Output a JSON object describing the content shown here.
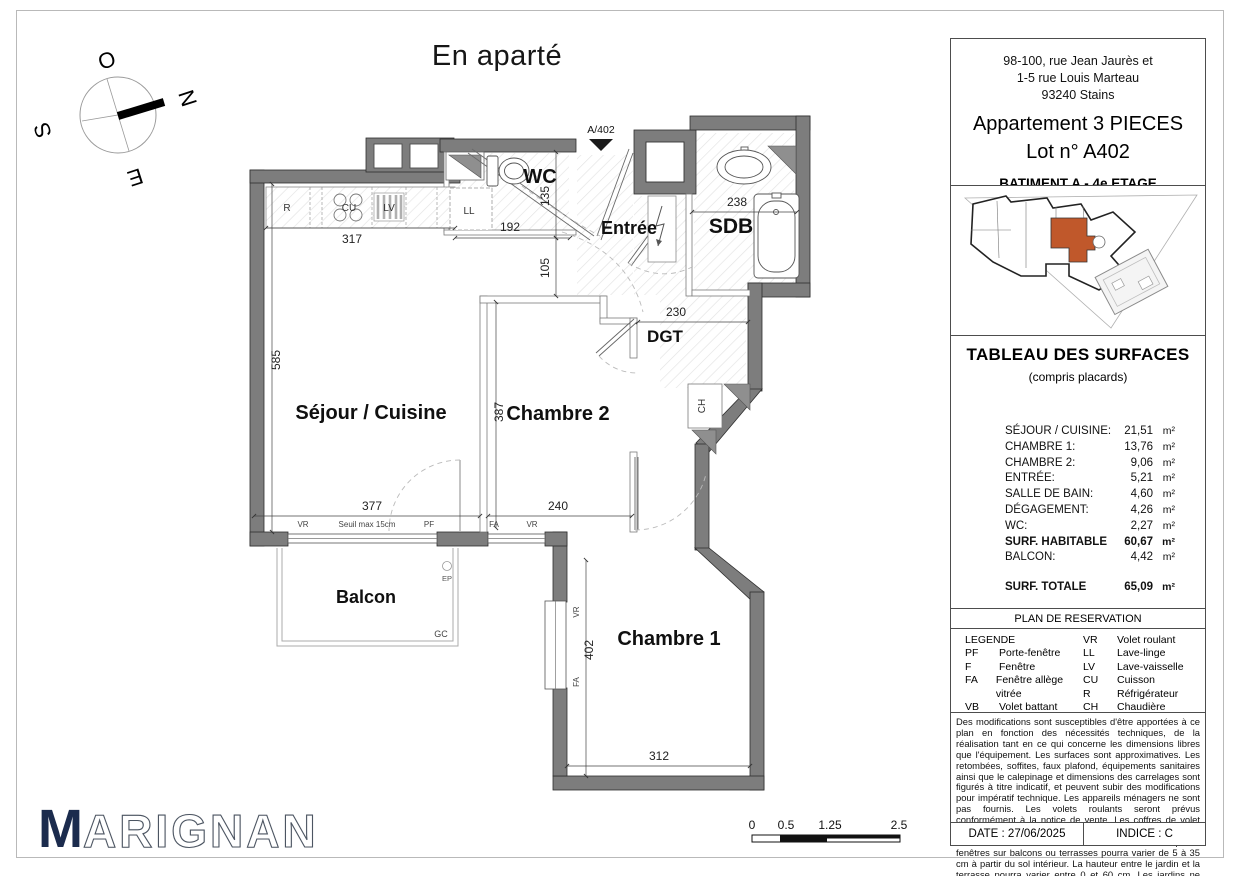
{
  "title": "En aparté",
  "colors": {
    "accent": "#C0582B",
    "wall": "#7D7D7D",
    "navy": "#1B2B4D"
  },
  "compass": {
    "o": "O",
    "n": "N",
    "s": "S",
    "e": "E"
  },
  "plan": {
    "marker": "A/402",
    "rooms": {
      "wc": "WC",
      "entree": "Entrée",
      "sdb": "SDB",
      "dgt": "DGT",
      "sejour": "Séjour / Cuisine",
      "chambre2": "Chambre 2",
      "chambre1": "Chambre 1",
      "balcon": "Balcon"
    },
    "appliances": {
      "r": "R",
      "cu": "CU",
      "lv": "LV",
      "ll": "LL",
      "ch": "CH"
    },
    "annotations": {
      "gc": "GC",
      "ep": "EP",
      "vr": "VR",
      "pf": "PF",
      "fa": "FA",
      "seuil": "Seuil max 15cm"
    },
    "dims": {
      "kitchen": "317",
      "wc_width": "192",
      "wc_height": "135",
      "hall": "105",
      "sdb": "238",
      "dgt": "230",
      "sejour_height": "585",
      "sejour_width": "377",
      "chambre2_height": "387",
      "chambre2_width": "240",
      "chambre1_height": "402",
      "chambre1_width": "312"
    }
  },
  "scalebar": {
    "t0": "0",
    "t1": "0.5",
    "t2": "1.25",
    "t3": "2.5"
  },
  "info": {
    "address1": "98-100, rue Jean Jaurès et",
    "address2": "1-5 rue Louis Marteau",
    "address3": "93240 Stains",
    "type": "Appartement 3 PIECES",
    "lot": "Lot n° A402",
    "floor": "BATIMENT A - 4e ETAGE"
  },
  "surfaces": {
    "title": "TABLEAU DES SURFACES",
    "subtitle": "(compris placards)",
    "rows": [
      {
        "label": "SÉJOUR / CUISINE:",
        "value": "21,51",
        "unit": "m²"
      },
      {
        "label": "CHAMBRE 1:",
        "value": "13,76",
        "unit": "m²"
      },
      {
        "label": "CHAMBRE 2:",
        "value": "9,06",
        "unit": "m²"
      },
      {
        "label": "ENTRÉE:",
        "value": "5,21",
        "unit": "m²"
      },
      {
        "label": "SALLE DE BAIN:",
        "value": "4,60",
        "unit": "m²"
      },
      {
        "label": "DÉGAGEMENT:",
        "value": "4,26",
        "unit": "m²"
      },
      {
        "label": "WC:",
        "value": "2,27",
        "unit": "m²"
      }
    ],
    "habitable": {
      "label": "SURF. HABITABLE",
      "value": "60,67",
      "unit": "m²"
    },
    "balcon": {
      "label": "BALCON:",
      "value": "4,42",
      "unit": "m²"
    },
    "total": {
      "label": "SURF. TOTALE",
      "value": "65,09",
      "unit": "m²"
    }
  },
  "reservation": {
    "title": "PLAN DE RESERVATION",
    "legend_header": "LEGENDE",
    "left": [
      {
        "abbr": "PF",
        "label": "Porte-fenêtre"
      },
      {
        "abbr": "F",
        "label": "Fenêtre"
      },
      {
        "abbr": "FA",
        "label": "Fenêtre allège vitrée"
      },
      {
        "abbr": "VB",
        "label": "Volet battant"
      },
      {
        "abbr": "GC",
        "label": "Garde corps"
      }
    ],
    "left_symbol_label": "Tableau électrique",
    "right": [
      {
        "abbr": "VR",
        "label": "Volet roulant"
      },
      {
        "abbr": "LL",
        "label": "Lave-linge"
      },
      {
        "abbr": "LV",
        "label": "Lave-vaisselle"
      },
      {
        "abbr": "CU",
        "label": "Cuisson"
      },
      {
        "abbr": "R",
        "label": "Réfrigérateur"
      },
      {
        "abbr": "CH",
        "label": "Chaudière"
      }
    ],
    "right_symbol_label": "Soffites et faux-plafond"
  },
  "disclaimer": "Des modifications sont susceptibles d'être apportées à ce plan en fonction des nécessités techniques, de la réalisation tant en ce qui concerne les dimensions libres que l'équipement. Les surfaces sont approximatives. Les retombées, soffites, faux plafond, équipements sanitaires ainsi que le calepinage et dimensions des carrelages sont figurés à titre indicatif, et peuvent subir des modifications pour impératif technique. Les appareils ménagers ne sont pas fournis.  Les volets roulants seront prévus conformément à la notice de vente. Les coffres de volet roulant ne sont pas représentés et seront débordants à l'intérieur. La hauteur des seuils au droit des porte-fenêtres sur balcons ou terrasses pourra varier de 5 à 35 cm à partir du sol intérieur. La hauteur entre le jardin et la terrasse pourra varier entre 0 et 60 cm. Les jardins ne seront pas nécessairement plats et pourront comporter des talus et des pentes.",
  "footer": {
    "date": "DATE : 27/06/2025",
    "indice": "INDICE : C"
  },
  "logo": {
    "m": "M",
    "rest": "ARIGNAN"
  }
}
